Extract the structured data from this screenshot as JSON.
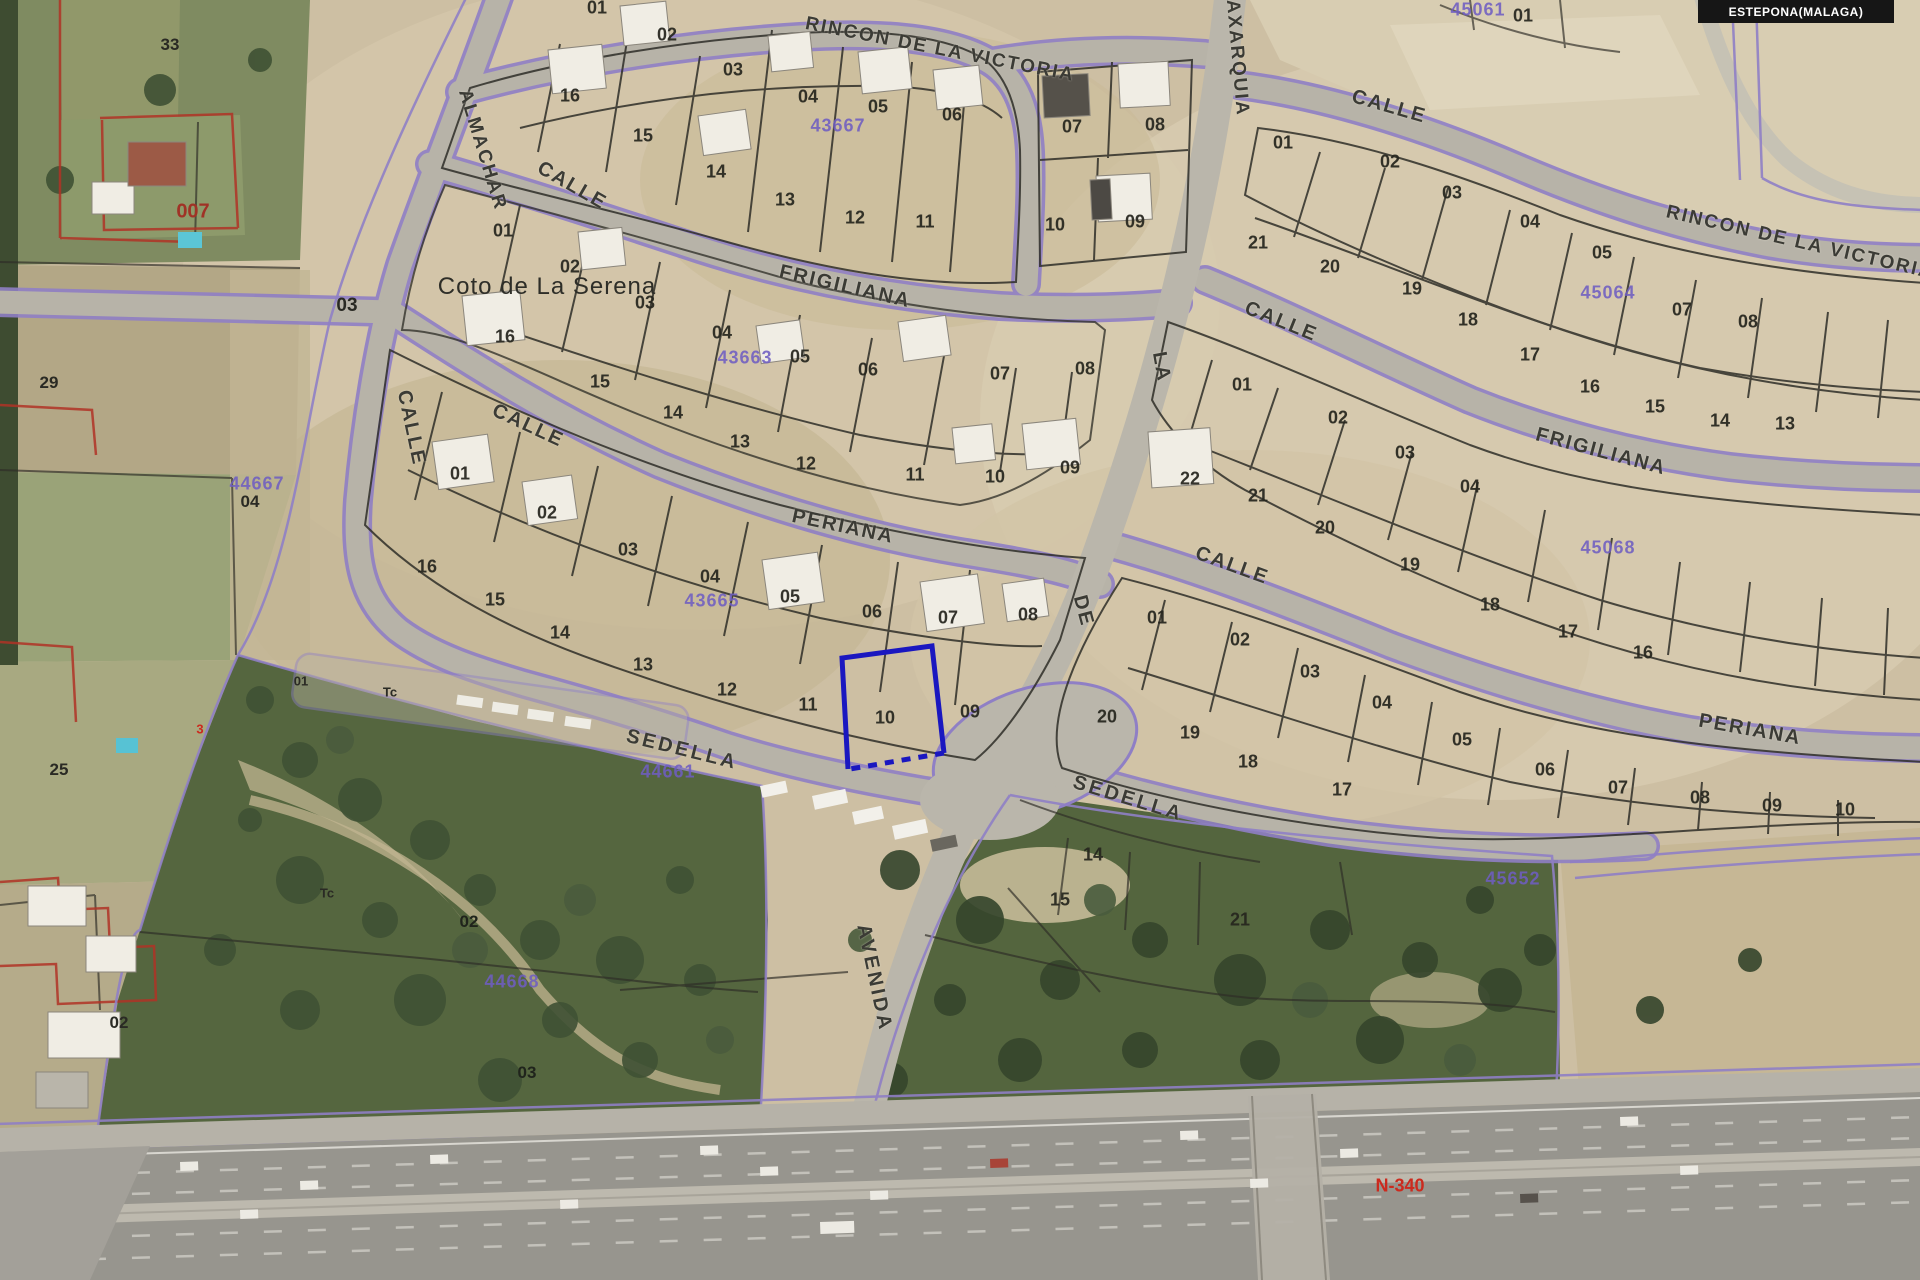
{
  "header": {
    "municipality_badge": "ESTEPONA(MALAGA)"
  },
  "map": {
    "place_label": "Coto de La Serena",
    "colors": {
      "selected_parcel": "#1a17c0",
      "cadastral_ref_purple": "#6f5ec2",
      "road_edge_purple": "#8f7fc5",
      "parcel_line_black": "#2e2d27",
      "rustic_red": "#b03226",
      "highway_red_label": "#cc2a1e"
    },
    "selected_parcel": {
      "number": "10",
      "street": "SEDELLA"
    },
    "street_labels": [
      {
        "t": "RINCON DE LA VICTORIA",
        "x": 940,
        "y": 50,
        "r": 11,
        "s": 19
      },
      {
        "t": "ALMACHAR",
        "x": 482,
        "y": 150,
        "r": 73,
        "s": 19
      },
      {
        "t": "CALLE",
        "x": 572,
        "y": 186,
        "r": 30,
        "s": 20
      },
      {
        "t": "FRIGILIANA",
        "x": 845,
        "y": 287,
        "r": 13,
        "s": 20
      },
      {
        "t": "CALLE",
        "x": 411,
        "y": 428,
        "r": 78,
        "s": 20
      },
      {
        "t": "CALLE",
        "x": 528,
        "y": 426,
        "r": 25,
        "s": 20
      },
      {
        "t": "PERIANA",
        "x": 843,
        "y": 527,
        "r": 12,
        "s": 20
      },
      {
        "t": "SEDELLA",
        "x": 682,
        "y": 750,
        "r": 14,
        "s": 20,
        "sp": 3
      },
      {
        "t": "AXARQUIA",
        "x": 1237,
        "y": 58,
        "r": 85,
        "s": 19
      },
      {
        "t": "LA",
        "x": 1161,
        "y": 367,
        "r": 80,
        "s": 20
      },
      {
        "t": "DE",
        "x": 1083,
        "y": 611,
        "r": 75,
        "s": 20
      },
      {
        "t": "AVENIDA",
        "x": 874,
        "y": 978,
        "r": 78,
        "s": 20,
        "sp": 3
      },
      {
        "t": "CALLE",
        "x": 1389,
        "y": 107,
        "r": 16,
        "s": 20
      },
      {
        "t": "RINCON DE LA VICTORIA",
        "x": 1800,
        "y": 243,
        "r": 13,
        "s": 19
      },
      {
        "t": "CALLE",
        "x": 1281,
        "y": 322,
        "r": 22,
        "s": 20
      },
      {
        "t": "FRIGILIANA",
        "x": 1601,
        "y": 452,
        "r": 15,
        "s": 20
      },
      {
        "t": "CALLE",
        "x": 1232,
        "y": 566,
        "r": 20,
        "s": 20
      },
      {
        "t": "PERIANA",
        "x": 1750,
        "y": 730,
        "r": 10,
        "s": 20
      },
      {
        "t": "SEDELLA",
        "x": 1128,
        "y": 799,
        "r": 17,
        "s": 20,
        "sp": 3
      }
    ],
    "parcel_numbers": [
      {
        "t": "01",
        "x": 597,
        "y": 8
      },
      {
        "t": "02",
        "x": 667,
        "y": 35
      },
      {
        "t": "03",
        "x": 733,
        "y": 70
      },
      {
        "t": "04",
        "x": 808,
        "y": 97
      },
      {
        "t": "05",
        "x": 878,
        "y": 107
      },
      {
        "t": "06",
        "x": 952,
        "y": 115
      },
      {
        "t": "16",
        "x": 570,
        "y": 96
      },
      {
        "t": "15",
        "x": 643,
        "y": 136
      },
      {
        "t": "14",
        "x": 716,
        "y": 172
      },
      {
        "t": "13",
        "x": 785,
        "y": 200
      },
      {
        "t": "12",
        "x": 855,
        "y": 218
      },
      {
        "t": "11",
        "x": 925,
        "y": 222
      },
      {
        "t": "07",
        "x": 1072,
        "y": 127
      },
      {
        "t": "08",
        "x": 1155,
        "y": 125
      },
      {
        "t": "10",
        "x": 1055,
        "y": 225
      },
      {
        "t": "09",
        "x": 1135,
        "y": 222
      },
      {
        "t": "01",
        "x": 503,
        "y": 231
      },
      {
        "t": "02",
        "x": 570,
        "y": 267
      },
      {
        "t": "03",
        "x": 645,
        "y": 303
      },
      {
        "t": "04",
        "x": 722,
        "y": 333
      },
      {
        "t": "05",
        "x": 800,
        "y": 357
      },
      {
        "t": "06",
        "x": 868,
        "y": 370
      },
      {
        "t": "07",
        "x": 1000,
        "y": 374
      },
      {
        "t": "08",
        "x": 1085,
        "y": 369
      },
      {
        "t": "16",
        "x": 505,
        "y": 337
      },
      {
        "t": "15",
        "x": 600,
        "y": 382
      },
      {
        "t": "14",
        "x": 673,
        "y": 413
      },
      {
        "t": "13",
        "x": 740,
        "y": 442
      },
      {
        "t": "12",
        "x": 806,
        "y": 464
      },
      {
        "t": "11",
        "x": 915,
        "y": 475
      },
      {
        "t": "10",
        "x": 995,
        "y": 477
      },
      {
        "t": "09",
        "x": 1070,
        "y": 468
      },
      {
        "t": "01",
        "x": 460,
        "y": 474
      },
      {
        "t": "02",
        "x": 547,
        "y": 513
      },
      {
        "t": "03",
        "x": 628,
        "y": 550
      },
      {
        "t": "04",
        "x": 710,
        "y": 577
      },
      {
        "t": "05",
        "x": 790,
        "y": 597
      },
      {
        "t": "06",
        "x": 872,
        "y": 612
      },
      {
        "t": "07",
        "x": 948,
        "y": 618
      },
      {
        "t": "08",
        "x": 1028,
        "y": 615
      },
      {
        "t": "16",
        "x": 427,
        "y": 567
      },
      {
        "t": "15",
        "x": 495,
        "y": 600
      },
      {
        "t": "14",
        "x": 560,
        "y": 633
      },
      {
        "t": "13",
        "x": 643,
        "y": 665
      },
      {
        "t": "12",
        "x": 727,
        "y": 690
      },
      {
        "t": "11",
        "x": 808,
        "y": 705
      },
      {
        "t": "10",
        "x": 885,
        "y": 718
      },
      {
        "t": "09",
        "x": 970,
        "y": 712
      },
      {
        "t": "01",
        "x": 1283,
        "y": 143
      },
      {
        "t": "02",
        "x": 1390,
        "y": 162
      },
      {
        "t": "03",
        "x": 1452,
        "y": 193
      },
      {
        "t": "04",
        "x": 1530,
        "y": 222
      },
      {
        "t": "05",
        "x": 1602,
        "y": 253
      },
      {
        "t": "07",
        "x": 1682,
        "y": 310
      },
      {
        "t": "08",
        "x": 1748,
        "y": 322
      },
      {
        "t": "21",
        "x": 1258,
        "y": 243
      },
      {
        "t": "20",
        "x": 1330,
        "y": 267
      },
      {
        "t": "19",
        "x": 1412,
        "y": 289
      },
      {
        "t": "18",
        "x": 1468,
        "y": 320
      },
      {
        "t": "17",
        "x": 1530,
        "y": 355
      },
      {
        "t": "16",
        "x": 1590,
        "y": 387
      },
      {
        "t": "15",
        "x": 1655,
        "y": 407
      },
      {
        "t": "14",
        "x": 1720,
        "y": 421
      },
      {
        "t": "13",
        "x": 1785,
        "y": 424
      },
      {
        "t": "01",
        "x": 1242,
        "y": 385
      },
      {
        "t": "02",
        "x": 1338,
        "y": 418
      },
      {
        "t": "03",
        "x": 1405,
        "y": 453
      },
      {
        "t": "04",
        "x": 1470,
        "y": 487
      },
      {
        "t": "22",
        "x": 1190,
        "y": 479
      },
      {
        "t": "21",
        "x": 1258,
        "y": 496
      },
      {
        "t": "20",
        "x": 1325,
        "y": 528
      },
      {
        "t": "19",
        "x": 1410,
        "y": 565
      },
      {
        "t": "18",
        "x": 1490,
        "y": 605
      },
      {
        "t": "17",
        "x": 1568,
        "y": 632
      },
      {
        "t": "16",
        "x": 1643,
        "y": 653
      },
      {
        "t": "01",
        "x": 1157,
        "y": 618
      },
      {
        "t": "02",
        "x": 1240,
        "y": 640
      },
      {
        "t": "03",
        "x": 1310,
        "y": 672
      },
      {
        "t": "04",
        "x": 1382,
        "y": 703
      },
      {
        "t": "05",
        "x": 1462,
        "y": 740
      },
      {
        "t": "06",
        "x": 1545,
        "y": 770
      },
      {
        "t": "07",
        "x": 1618,
        "y": 788
      },
      {
        "t": "08",
        "x": 1700,
        "y": 798
      },
      {
        "t": "09",
        "x": 1772,
        "y": 806
      },
      {
        "t": "10",
        "x": 1845,
        "y": 810
      },
      {
        "t": "20",
        "x": 1107,
        "y": 717
      },
      {
        "t": "19",
        "x": 1190,
        "y": 733
      },
      {
        "t": "18",
        "x": 1248,
        "y": 762
      },
      {
        "t": "17",
        "x": 1342,
        "y": 790
      },
      {
        "t": "14",
        "x": 1093,
        "y": 855
      },
      {
        "t": "15",
        "x": 1060,
        "y": 900
      },
      {
        "t": "21",
        "x": 1240,
        "y": 920
      },
      {
        "t": "01",
        "x": 1523,
        "y": 16
      }
    ],
    "cadastral_refs": [
      {
        "t": "43667",
        "x": 838,
        "y": 126
      },
      {
        "t": "43663",
        "x": 745,
        "y": 358
      },
      {
        "t": "43665",
        "x": 712,
        "y": 601
      },
      {
        "t": "44661",
        "x": 668,
        "y": 772
      },
      {
        "t": "44668",
        "x": 512,
        "y": 982
      },
      {
        "t": "45652",
        "x": 1513,
        "y": 879
      },
      {
        "t": "45064",
        "x": 1608,
        "y": 293
      },
      {
        "t": "45068",
        "x": 1608,
        "y": 548
      },
      {
        "t": "44667",
        "x": 257,
        "y": 484
      },
      {
        "t": "45061",
        "x": 1478,
        "y": 10
      }
    ],
    "misc_labels": [
      {
        "t": "007",
        "x": 193,
        "y": 212,
        "s": 20,
        "c": "#a03226"
      },
      {
        "t": "N-340",
        "x": 1400,
        "y": 1186,
        "s": 18,
        "c": "#cc2a1e"
      },
      {
        "t": "3",
        "x": 200,
        "y": 729,
        "s": 13,
        "c": "#cc2a1e"
      },
      {
        "t": "33",
        "x": 170,
        "y": 45,
        "s": 17,
        "c": "#2a2a24"
      },
      {
        "t": "29",
        "x": 49,
        "y": 383,
        "s": 17,
        "c": "#2a2a24"
      },
      {
        "t": "25",
        "x": 59,
        "y": 770,
        "s": 17,
        "c": "#2a2a24"
      },
      {
        "t": "02",
        "x": 119,
        "y": 1023,
        "s": 17,
        "c": "#2a2a24"
      },
      {
        "t": "03",
        "x": 347,
        "y": 306,
        "s": 19,
        "c": "#2a2a24"
      },
      {
        "t": "04",
        "x": 250,
        "y": 502,
        "s": 17,
        "c": "#2a2a24"
      },
      {
        "t": "02",
        "x": 469,
        "y": 922,
        "s": 17,
        "c": "#20241c"
      },
      {
        "t": "03",
        "x": 527,
        "y": 1073,
        "s": 17,
        "c": "#20241c"
      },
      {
        "t": "Tc",
        "x": 390,
        "y": 692,
        "s": 13,
        "c": "#2a2a24"
      },
      {
        "t": "Tc",
        "x": 327,
        "y": 893,
        "s": 13,
        "c": "#2a2a24"
      },
      {
        "t": "01",
        "x": 301,
        "y": 681,
        "s": 13,
        "c": "#2a2a24"
      }
    ]
  }
}
